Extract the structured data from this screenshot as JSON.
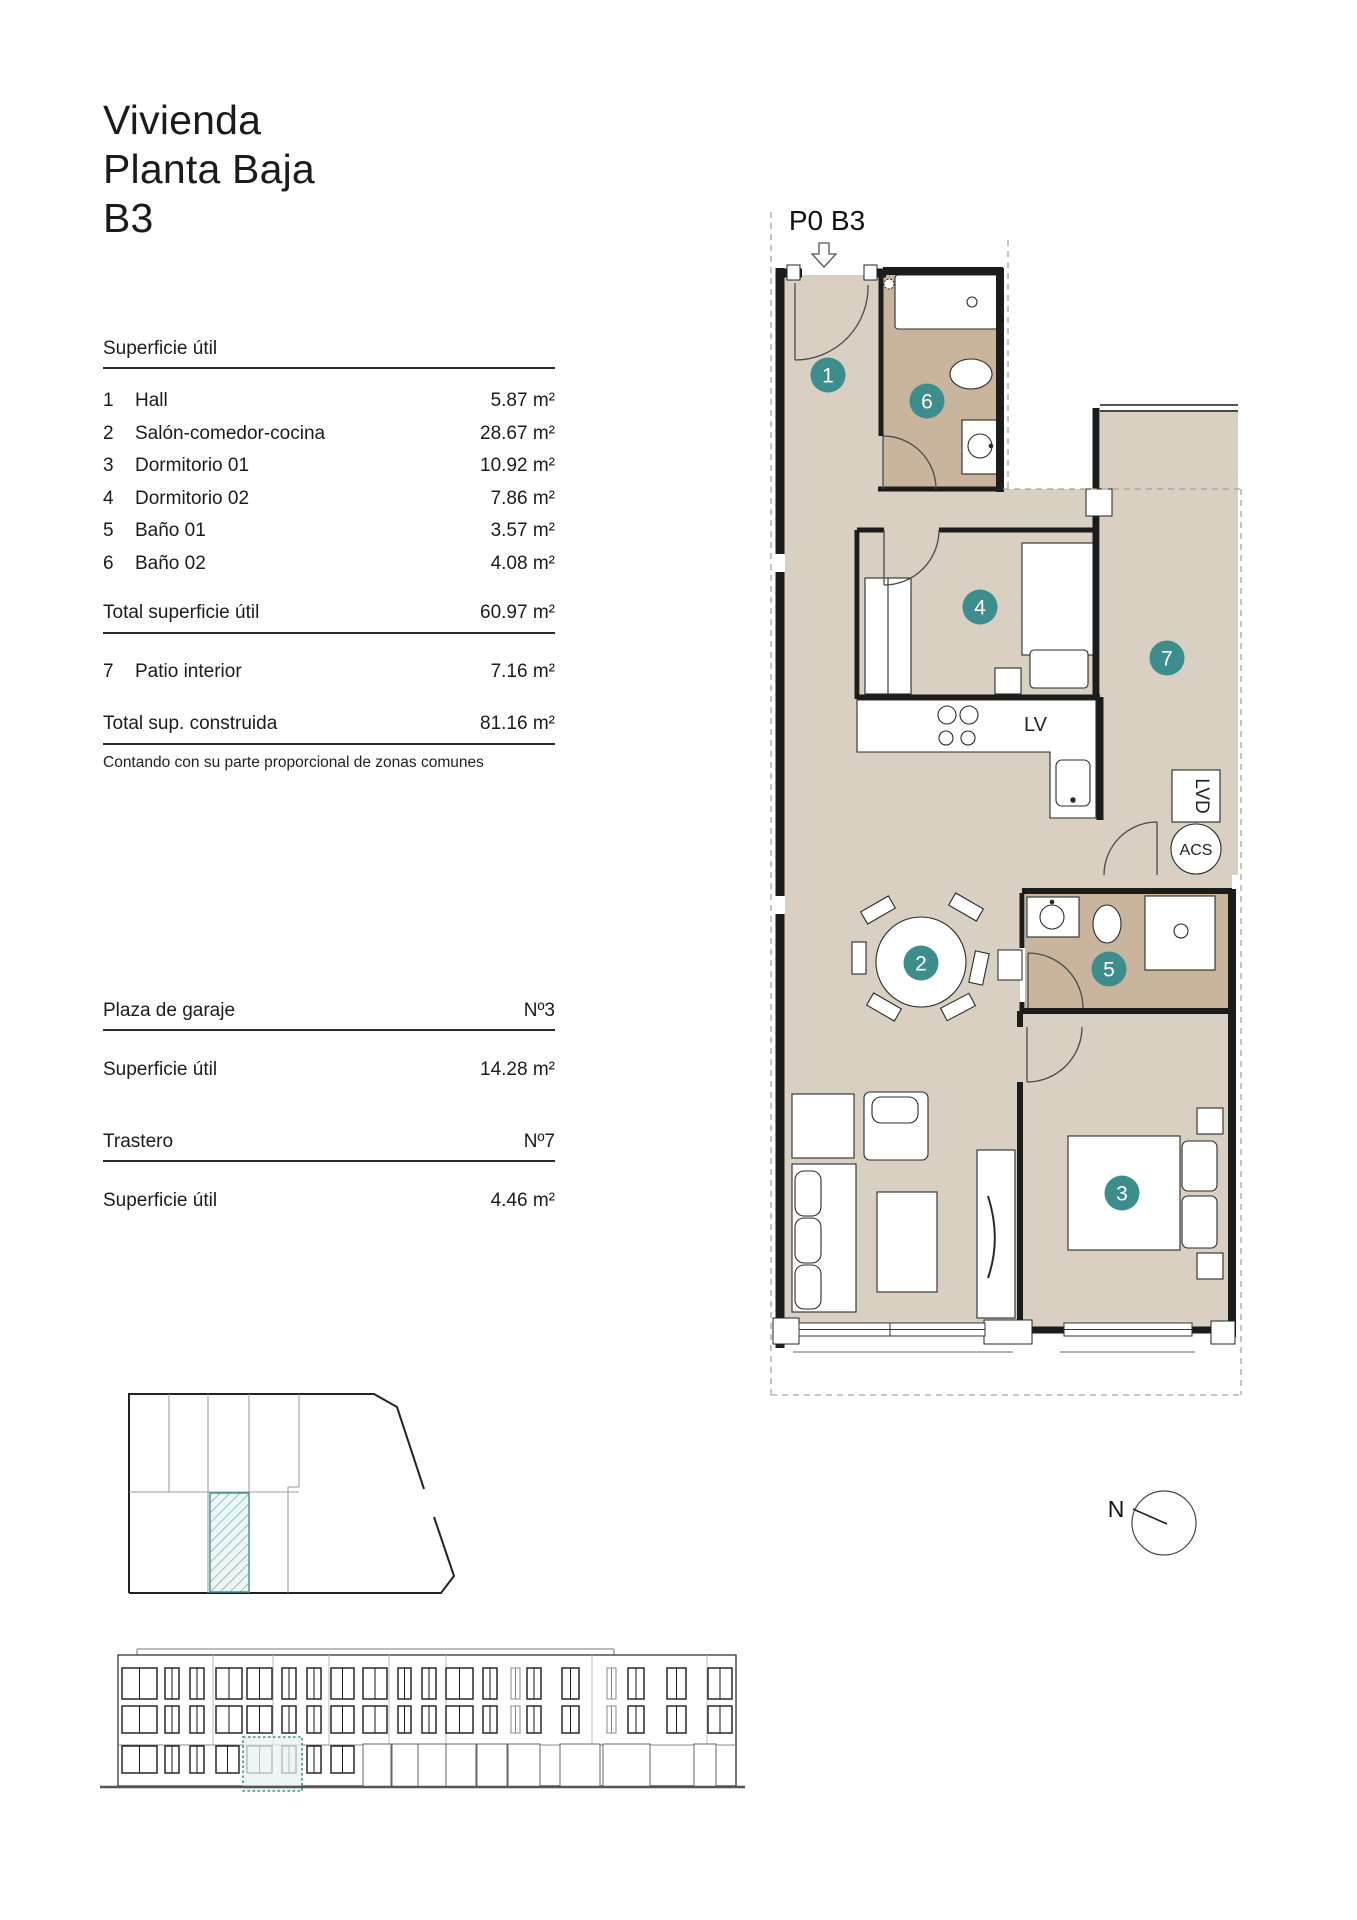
{
  "title": {
    "line1": "Vivienda",
    "line2": "Planta Baja",
    "line3": "B3"
  },
  "surface_table": {
    "header": "Superficie útil",
    "rows": [
      {
        "num": "1",
        "label": "Hall",
        "value": "5.87 m²"
      },
      {
        "num": "2",
        "label": "Salón-comedor-cocina",
        "value": "28.67 m²"
      },
      {
        "num": "3",
        "label": "Dormitorio 01",
        "value": "10.92 m²"
      },
      {
        "num": "4",
        "label": "Dormitorio 02",
        "value": "7.86 m²"
      },
      {
        "num": "5",
        "label": "Baño 01",
        "value": "3.57 m²"
      },
      {
        "num": "6",
        "label": "Baño 02",
        "value": "4.08 m²"
      }
    ],
    "total": {
      "label": "Total superficie útil",
      "value": "60.97 m²"
    },
    "patio_row": {
      "num": "7",
      "label": "Patio interior",
      "value": "7.16 m²"
    },
    "total_built": {
      "label": "Total sup. construida",
      "value": "81.16 m²"
    },
    "note": "Contando con su parte proporcional de zonas comunes"
  },
  "garage": {
    "header": "Plaza de garaje",
    "number": "Nº3",
    "label": "Superficie útil",
    "value": "14.28 m²"
  },
  "storage": {
    "header": "Trastero",
    "number": "Nº7",
    "label": "Superficie útil",
    "value": "4.46 m²"
  },
  "plan": {
    "unit_label": "P0 B3",
    "appliances": {
      "dishwasher": "LV",
      "washer": "LVD",
      "water_heater": "ACS"
    },
    "rooms": [
      {
        "number": "1"
      },
      {
        "number": "2"
      },
      {
        "number": "3"
      },
      {
        "number": "4"
      },
      {
        "number": "5"
      },
      {
        "number": "6"
      },
      {
        "number": "7"
      }
    ],
    "compass_north": "N"
  },
  "colors": {
    "accent_teal": "#3c8d8b",
    "room_fill": "#d9cfc3",
    "bath_fill": "#c9b59d",
    "highlight_border": "#3f8f8e"
  }
}
